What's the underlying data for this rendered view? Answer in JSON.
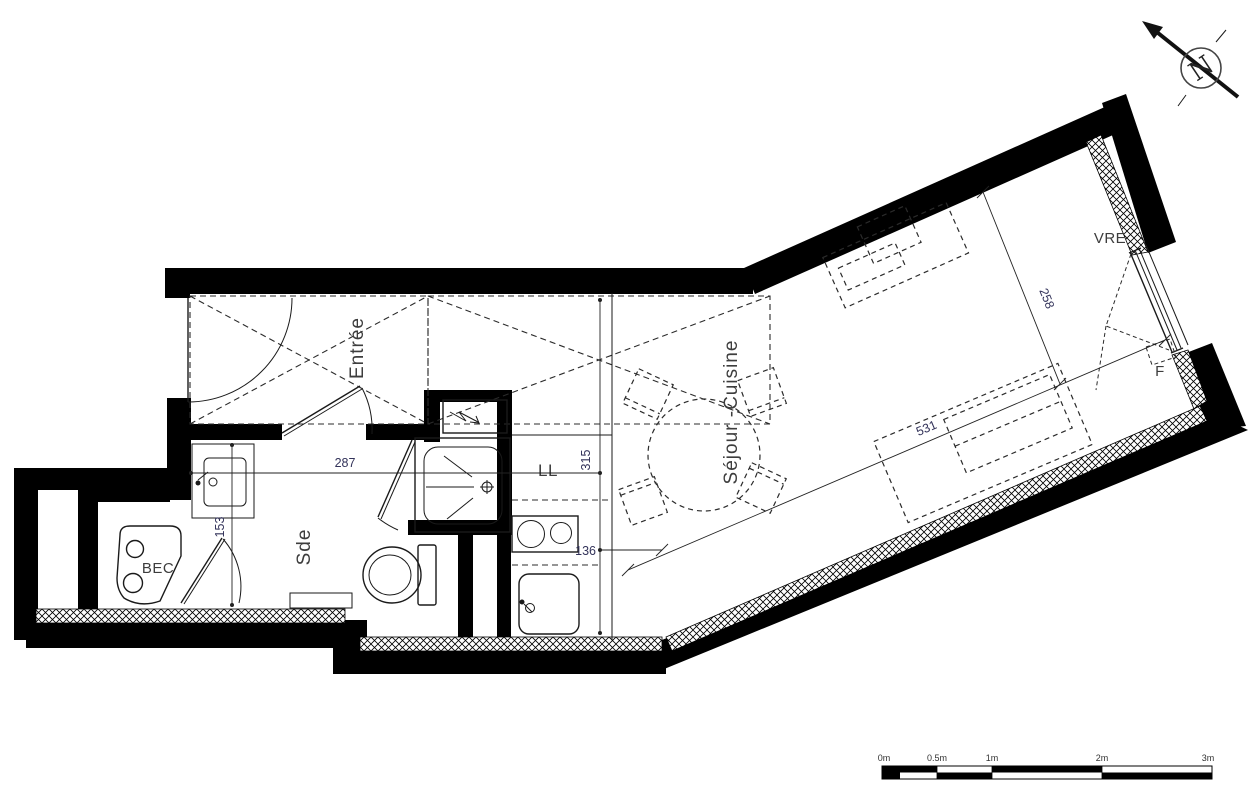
{
  "rooms": {
    "entree": "Entrée",
    "sejour_cuisine": "Séjour -Cuisine",
    "sde": "Sde",
    "bec": "BEC"
  },
  "fixtures": {
    "washing_machine": "LL",
    "roller_shutter_window": "VRE",
    "window": "F"
  },
  "dimensions": {
    "d287": "287",
    "d153": "153",
    "d315": "315",
    "d136": "136",
    "d531": "531",
    "d258": "258"
  },
  "north": {
    "label": "N"
  },
  "scale_bar": {
    "ticks": [
      "0m",
      "0.5m",
      "1m",
      "2m",
      "3m"
    ]
  },
  "colors": {
    "wall": "#000000",
    "line": "#1a1a1a",
    "label": "#3d3d3d"
  }
}
